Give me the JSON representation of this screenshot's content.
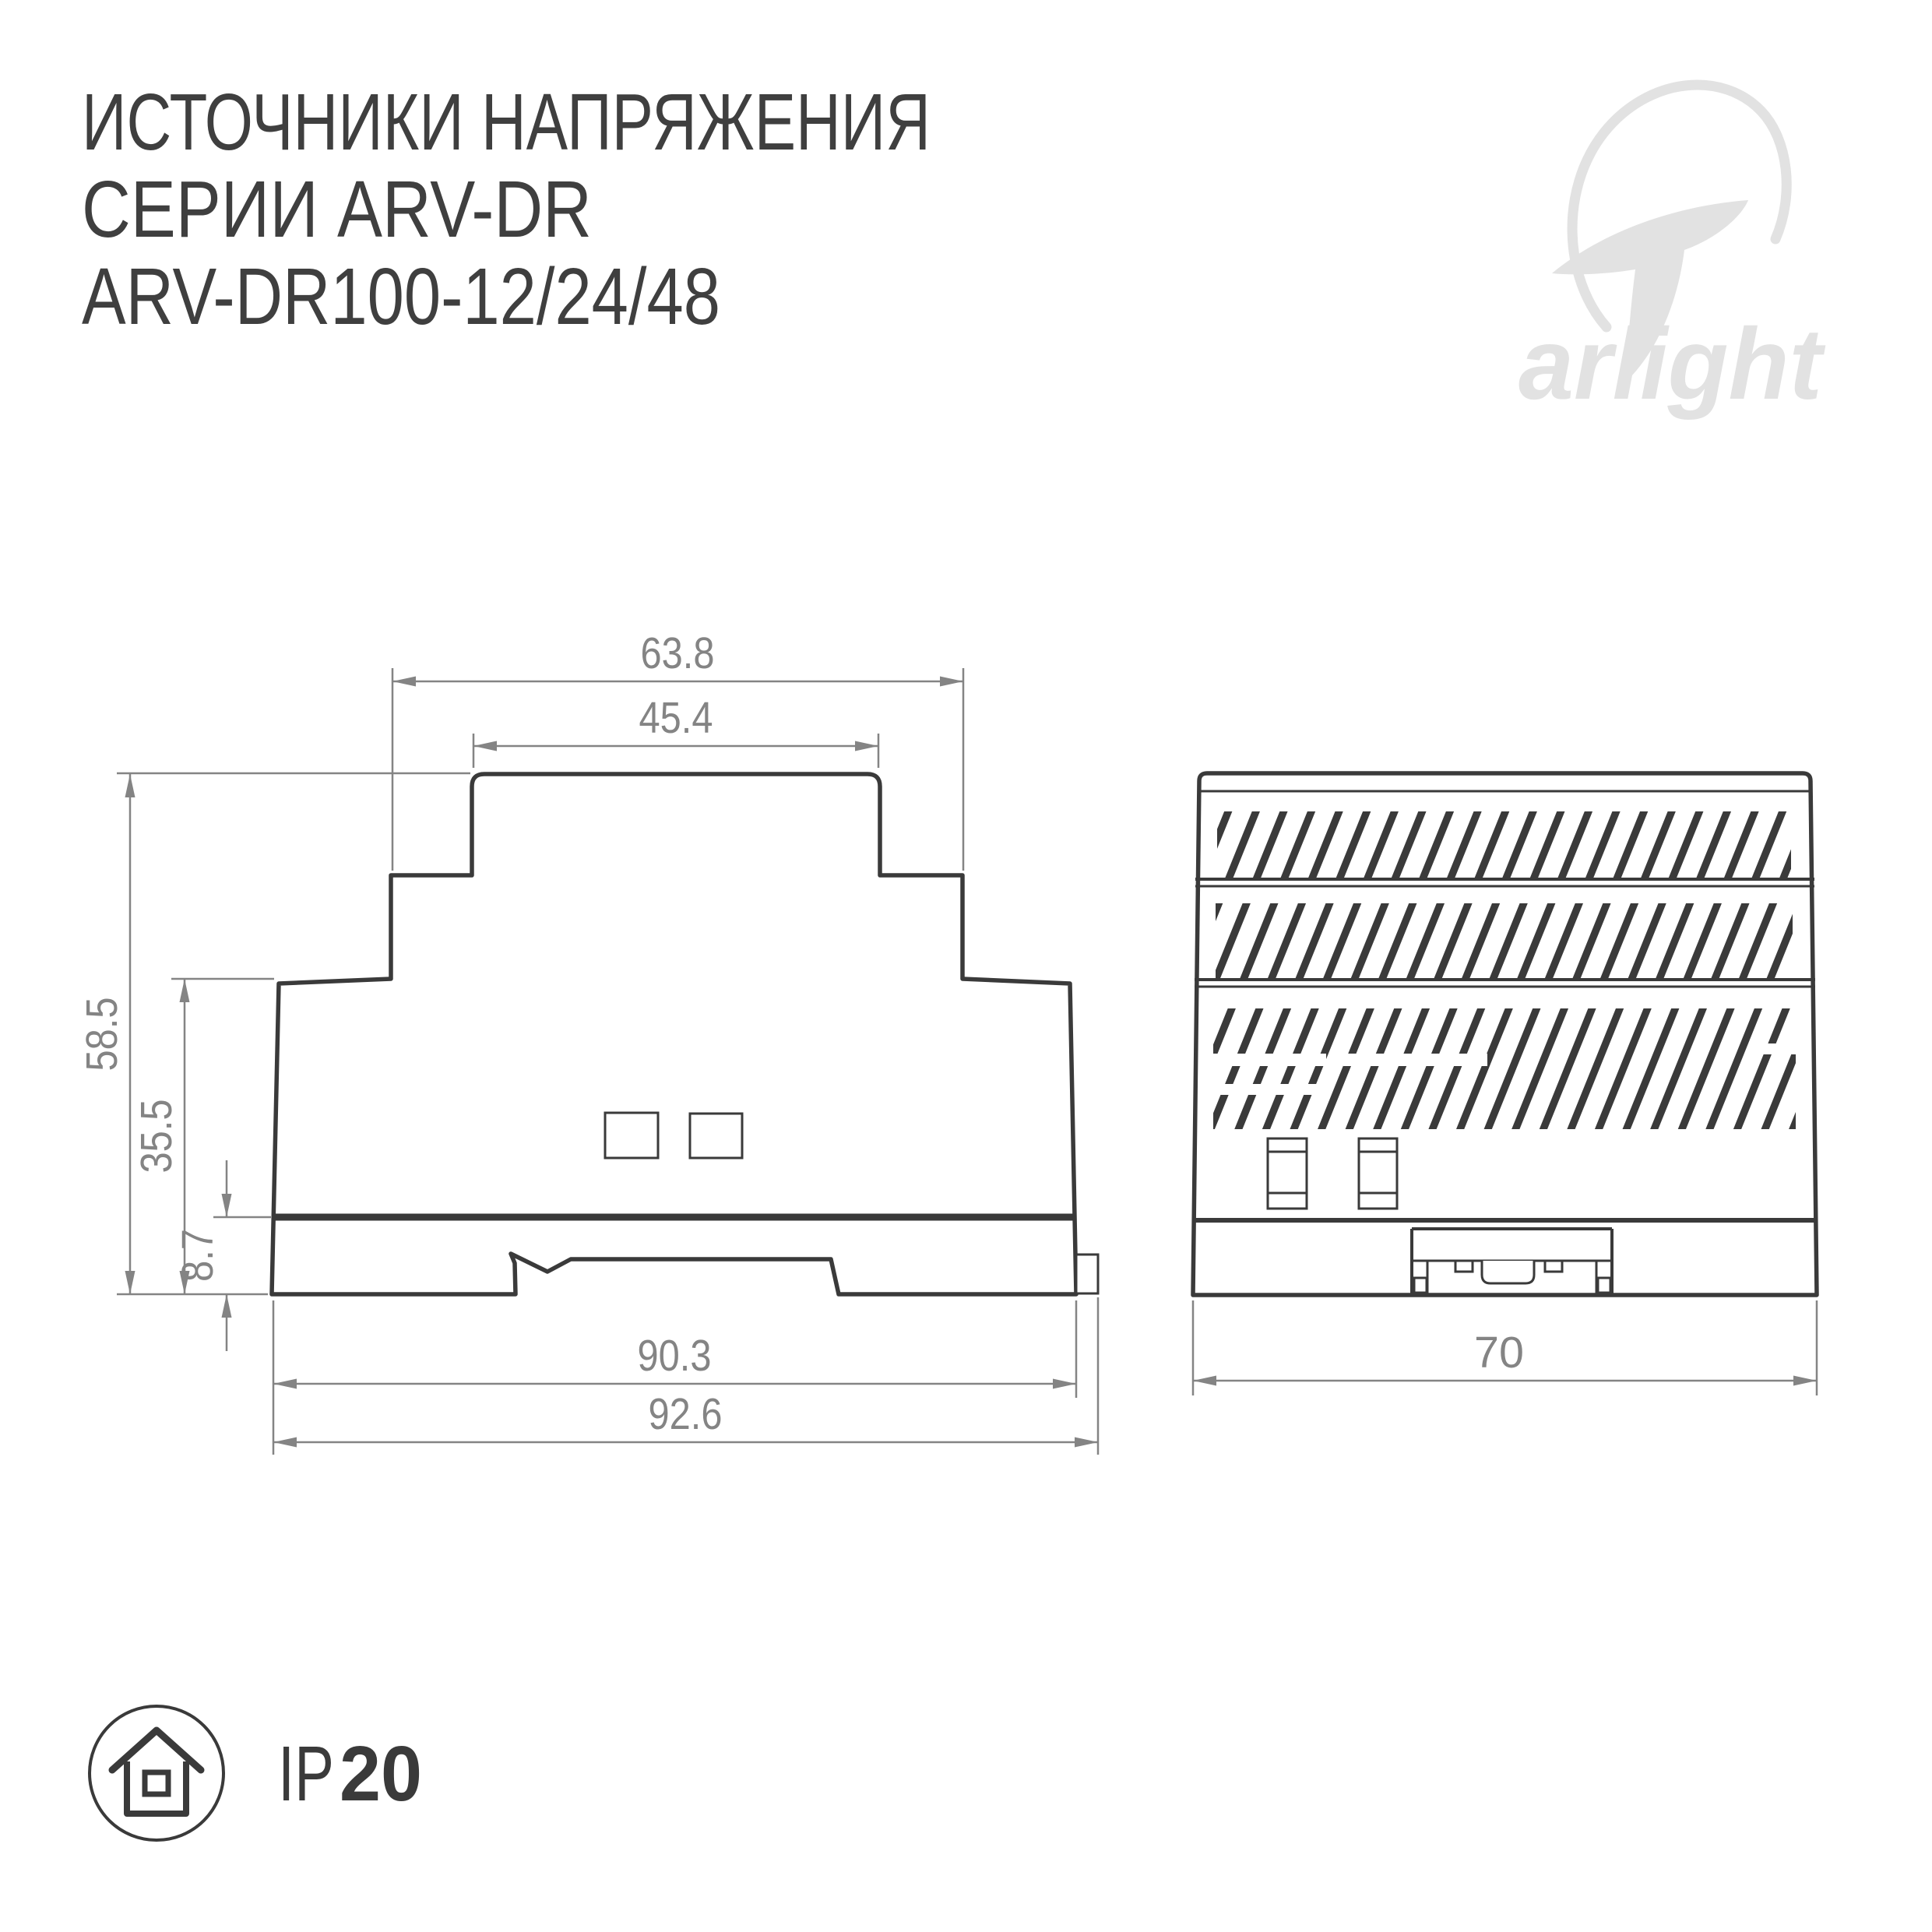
{
  "title": {
    "line1": "ИСТОЧНИКИ НАПРЯЖЕНИЯ",
    "line2": "СЕРИИ ARV-DR",
    "line3": "ARV-DR100-12/24/48"
  },
  "brand": {
    "logo_text": "arlight"
  },
  "drawings": {
    "side_view": {
      "dims": {
        "top_outer_width": "63.8",
        "top_inner_width": "45.4",
        "total_height": "58.5",
        "body_height": "35.5",
        "base_height": "8.7",
        "body_width": "90.3",
        "total_width": "92.6"
      }
    },
    "front_view": {
      "dims": {
        "width": "70"
      }
    }
  },
  "protection": {
    "prefix": "IP",
    "rating": "20"
  },
  "colors": {
    "background": "#ffffff",
    "outline": "#3a3a3a",
    "dimension": "#848484",
    "logo": "#e2e2e2",
    "title": "#3f3f3f"
  }
}
